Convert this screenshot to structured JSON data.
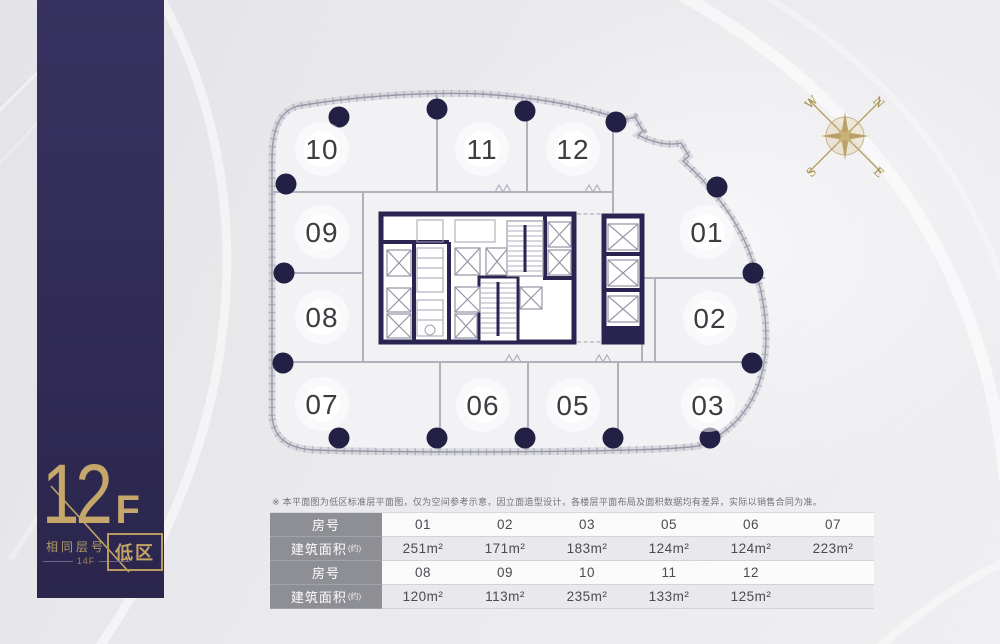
{
  "banner": {
    "floor_number": "12",
    "floor_suffix": "F",
    "same_floor_label": "相同层号",
    "same_floor_value": "14F",
    "zone": "低区"
  },
  "compass": {
    "n": "N",
    "e": "E",
    "s": "S",
    "w": "W"
  },
  "plan": {
    "units": [
      {
        "label": "10"
      },
      {
        "label": "11"
      },
      {
        "label": "12"
      },
      {
        "label": "09"
      },
      {
        "label": "01"
      },
      {
        "label": "08"
      },
      {
        "label": "02"
      },
      {
        "label": "07"
      },
      {
        "label": "06"
      },
      {
        "label": "05"
      },
      {
        "label": "03"
      }
    ]
  },
  "disclaimer": "※ 本平面图为低区标准层平面图，仅为空间参考示意，因立面造型设计，各楼层平面布局及面积数据均有差异，实际以销售合同为准。",
  "table": {
    "row_headers": [
      "房号",
      "建筑面积",
      "房号",
      "建筑面积"
    ],
    "area_note": "(约)",
    "rows": [
      [
        "01",
        "02",
        "03",
        "05",
        "06",
        "07"
      ],
      [
        "251m²",
        "171m²",
        "183m²",
        "124m²",
        "124m²",
        "223m²"
      ],
      [
        "08",
        "09",
        "10",
        "11",
        "12",
        ""
      ],
      [
        "120m²",
        "113m²",
        "235m²",
        "133m²",
        "125m²",
        ""
      ]
    ]
  },
  "colors": {
    "banner_navy": "#312b58",
    "gold": "#bfa268",
    "core_navy": "#2a2550",
    "column_navy": "#232045"
  }
}
